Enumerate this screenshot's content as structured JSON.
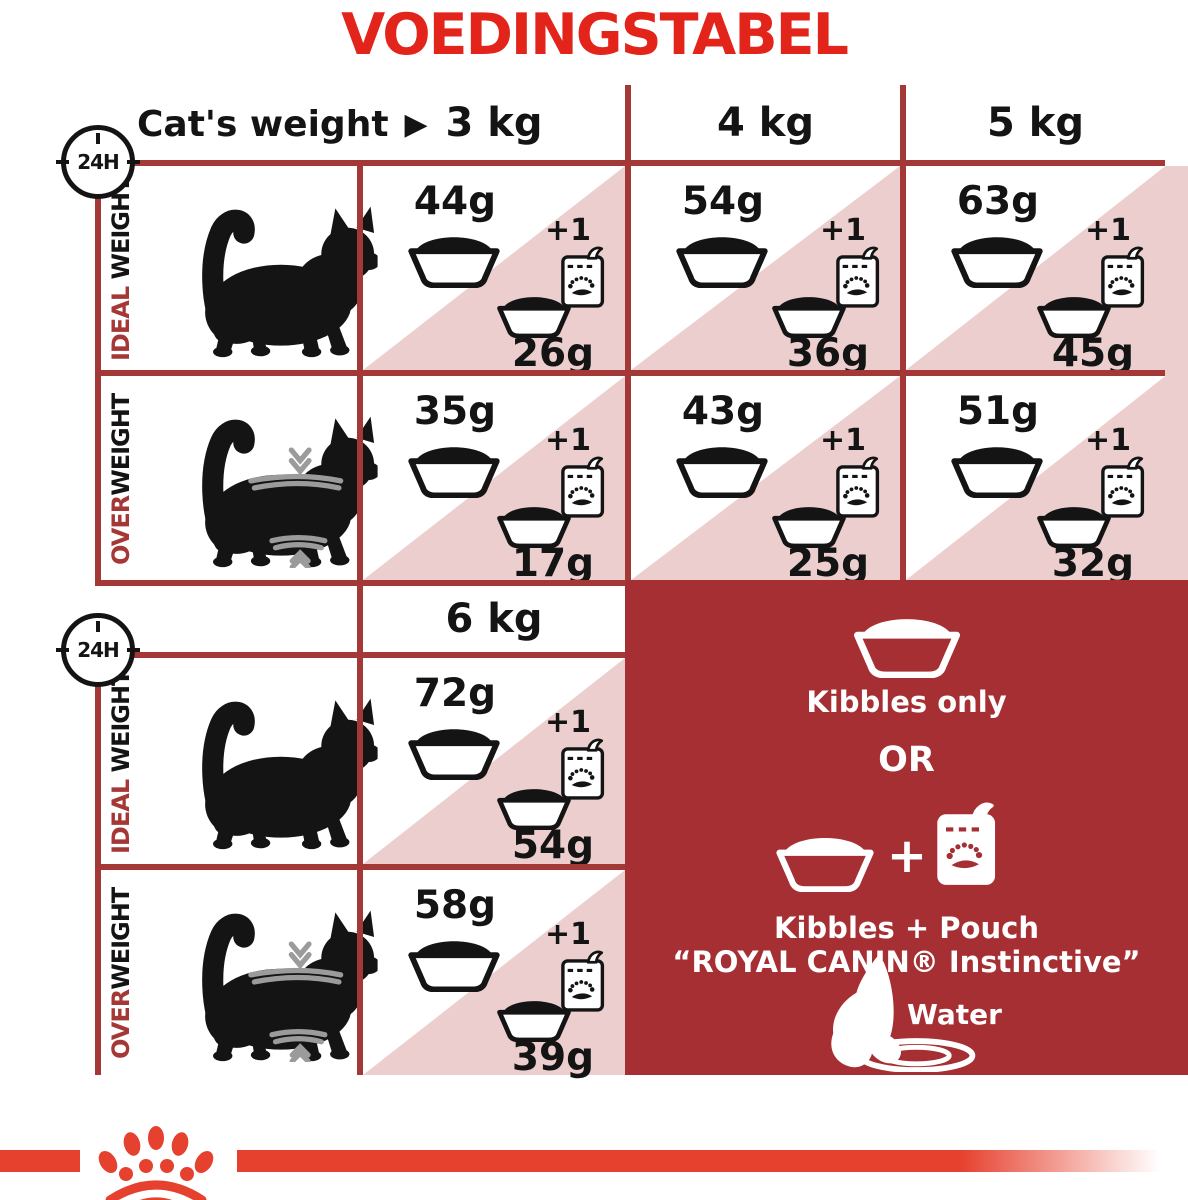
{
  "title": "VOEDINGSTABEL",
  "badge": "24H",
  "header": {
    "label": "Cat's weight",
    "arrow": "▶",
    "columns": [
      "3 kg",
      "4 kg",
      "5 kg"
    ]
  },
  "labels": {
    "ideal_accent": "IDEAL",
    "ideal_rest": " WEIGHT",
    "over_accent": "OVER",
    "over_rest": "WEIGHT"
  },
  "plus_one": "+1",
  "sections": [
    {
      "rows": [
        {
          "type": "ideal-weight",
          "cells": [
            {
              "kibble": "44g",
              "mix": "26g"
            },
            {
              "kibble": "54g",
              "mix": "36g"
            },
            {
              "kibble": "63g",
              "mix": "45g"
            }
          ]
        },
        {
          "type": "overweight",
          "cells": [
            {
              "kibble": "35g",
              "mix": "17g"
            },
            {
              "kibble": "43g",
              "mix": "25g"
            },
            {
              "kibble": "51g",
              "mix": "32g"
            }
          ]
        }
      ]
    },
    {
      "header": "6 kg",
      "rows": [
        {
          "type": "ideal-weight",
          "cells": [
            {
              "kibble": "72g",
              "mix": "54g"
            }
          ]
        },
        {
          "type": "overweight",
          "cells": [
            {
              "kibble": "58g",
              "mix": "39g"
            }
          ]
        }
      ]
    }
  ],
  "chart_data": {
    "type": "table",
    "title": "VOEDINGSTABEL",
    "categories": [
      "3 kg",
      "4 kg",
      "5 kg",
      "6 kg"
    ],
    "series": [
      {
        "name": "Ideal weight – kibbles only (g/24h)",
        "values": [
          44,
          54,
          63,
          72
        ]
      },
      {
        "name": "Ideal weight – kibbles with 1 pouch (g/24h)",
        "values": [
          26,
          36,
          45,
          54
        ]
      },
      {
        "name": "Overweight – kibbles only (g/24h)",
        "values": [
          35,
          43,
          51,
          58
        ]
      },
      {
        "name": "Overweight – kibbles with 1 pouch (g/24h)",
        "values": [
          17,
          25,
          32,
          39
        ]
      }
    ]
  },
  "panel": {
    "kibbles_only": "Kibbles only",
    "or": "OR",
    "plus": "+",
    "kibbles_pouch": "Kibbles + Pouch",
    "pouch_name": "“ROYAL CANIN® Instinctive”",
    "water": "Water"
  },
  "colors": {
    "brand_red": "#E2241B",
    "stripe_red": "#E6402E",
    "table_line_red": "#A43836",
    "panel_red": "#A52F33",
    "pink": "#EBCECD",
    "overweight_mark_gray": "#9B9B9B"
  },
  "icons": {
    "clock": "24h-clock-icon",
    "bowl": "food-bowl-icon",
    "pouch": "pouch-icon",
    "cat_ideal": "cat-silhouette-icon",
    "cat_overweight": "overweight-cat-silhouette-icon",
    "water": "cat-drinking-water-icon",
    "crown": "royal-canin-crown-logo"
  }
}
